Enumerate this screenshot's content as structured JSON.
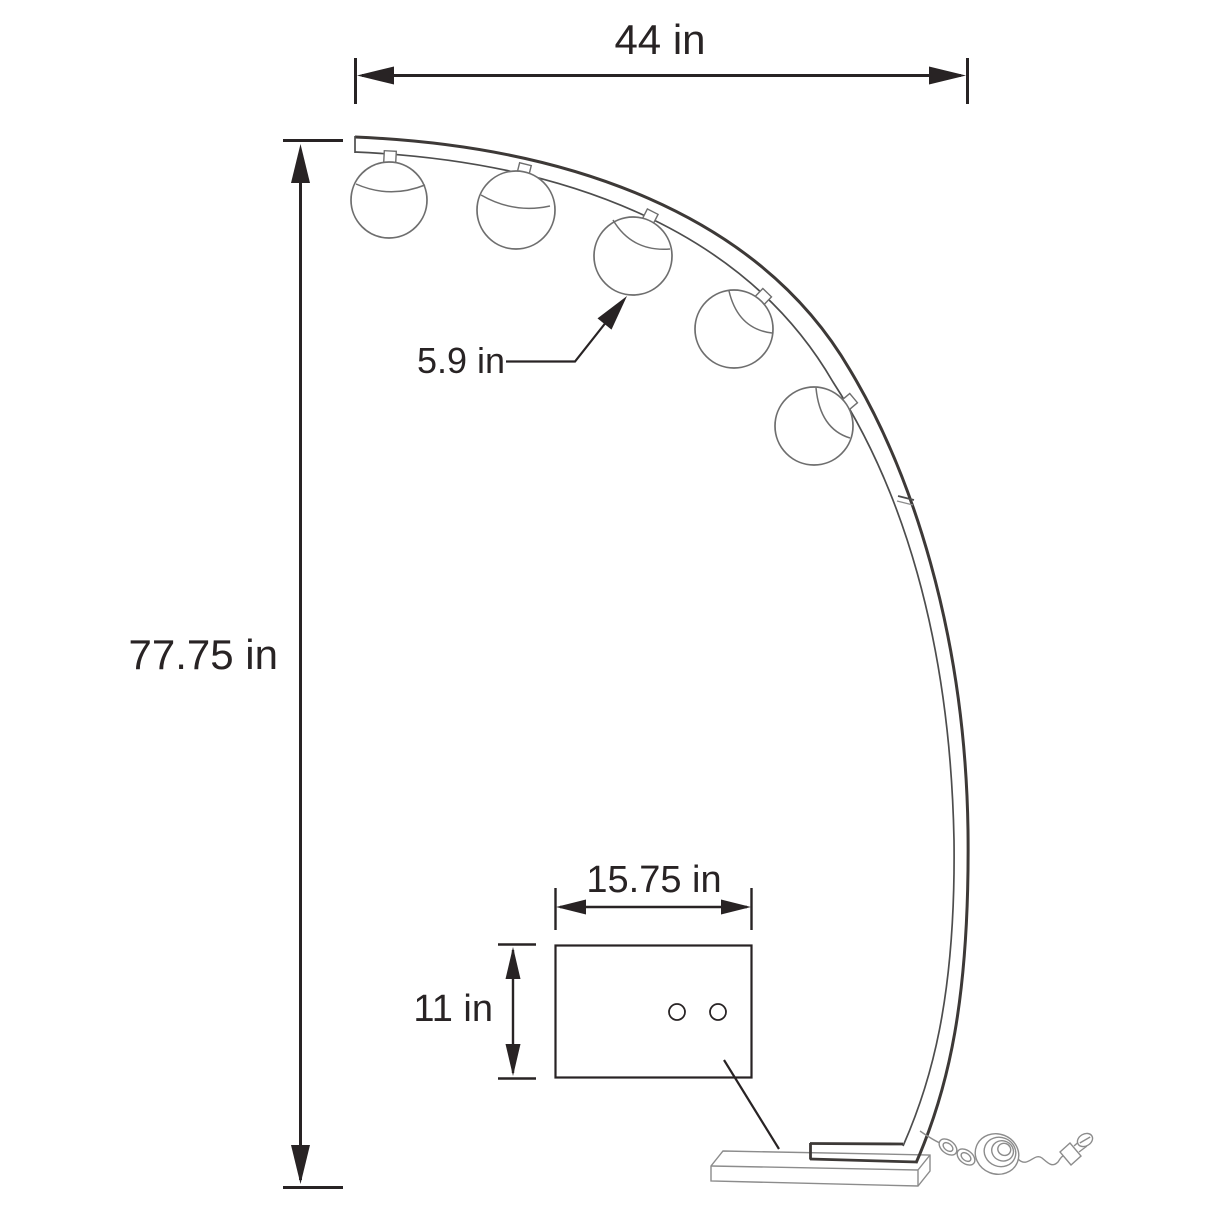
{
  "labels": {
    "overall_width": "44 in",
    "overall_height": "77.75 in",
    "globe_diameter": "5.9 in",
    "base_width": "15.75 in",
    "base_depth": "11 in"
  },
  "lamp": {
    "globe_count": 5
  },
  "colors": {
    "background": "#ffffff",
    "ink": "#282324",
    "lamp_dark": "#3d3937",
    "lamp_mid": "#4d4d4d",
    "lamp_light": "#6e6e6e",
    "accessory": "#8c8c8c"
  }
}
